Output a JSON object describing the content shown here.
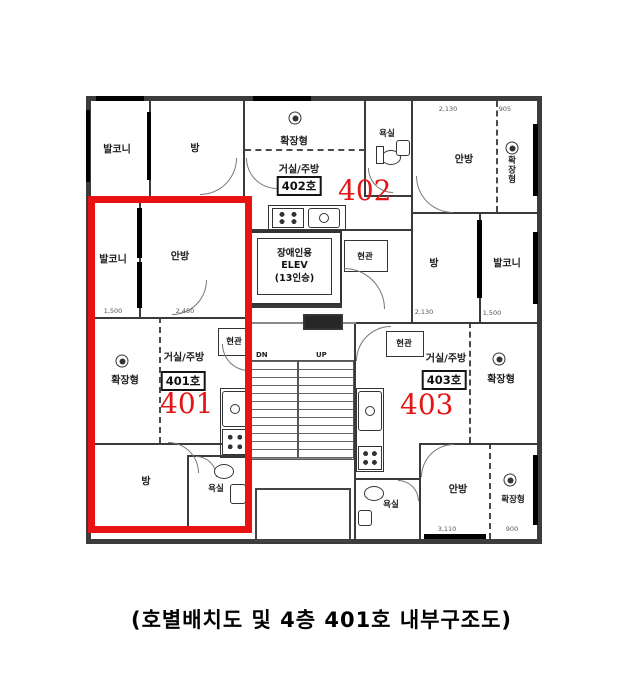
{
  "caption": "(호별배치도 및 4층 401호 내부구조도)",
  "colors": {
    "highlight_red": "#e81212",
    "wall": "#3a3a3a"
  },
  "rooms": {
    "balcony": "발코니",
    "room": "방",
    "master_bedroom": "안방",
    "bathroom": "욕실",
    "expanded": "확장형",
    "entrance": "현관",
    "living_kitchen": "거실/주방"
  },
  "units": {
    "u401": {
      "number": "401",
      "badge": "401호"
    },
    "u402": {
      "number": "402",
      "badge": "402호"
    },
    "u403": {
      "number": "403",
      "badge": "403호"
    }
  },
  "elevator": {
    "line1": "장애인용",
    "line2": "ELEV",
    "line3": "(13인승)"
  },
  "stairs": {
    "down": "DN",
    "up": "UP"
  },
  "dims": {
    "d1": "1,500",
    "d2": "2,450",
    "d3": "2,130",
    "d4": "905",
    "d5": "2,130",
    "d6": "1,500",
    "d7": "3,110",
    "d8": "900"
  }
}
